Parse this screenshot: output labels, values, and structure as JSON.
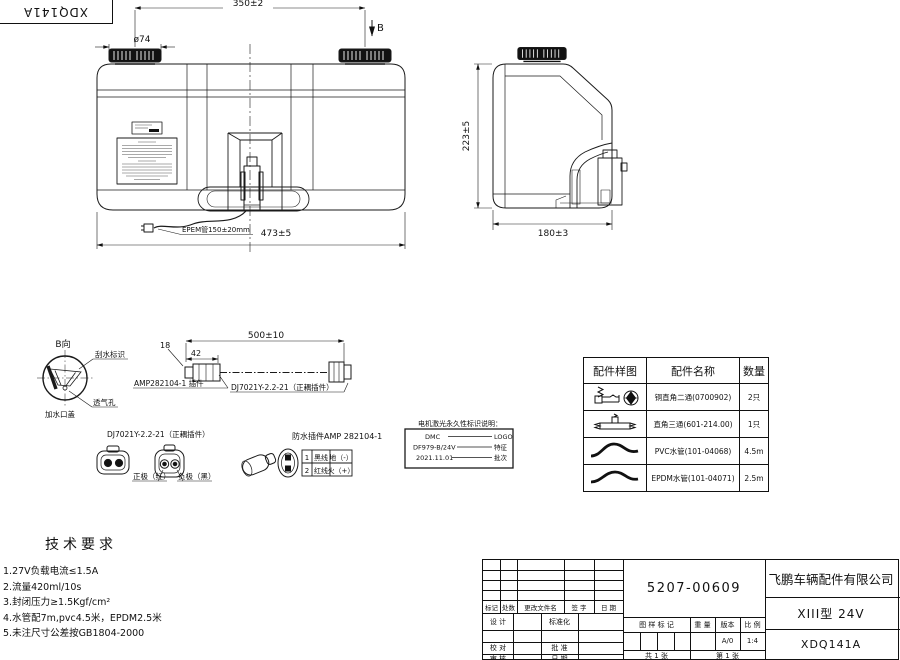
{
  "corner_stamp": {
    "text": "XDQ141A"
  },
  "front_view": {
    "dim_cap_spacing": "350±2",
    "dim_cap_diameter": "ø74",
    "section_marker": "B",
    "hose_label": "EPEM管150±20mm",
    "dim_overall_width": "473±5"
  },
  "side_view": {
    "dim_height": "223±5",
    "dim_depth": "180±3"
  },
  "view_b": {
    "title": "B向",
    "wiper_mark_label": "刮水标识",
    "vent_hole_label": "透气孔",
    "filler_cap_label": "加水口盖"
  },
  "cable_assembly": {
    "dim_connector": "18",
    "dim_lead": "42",
    "dim_length": "500±10",
    "left_connector_label": "AMP282104-1 插件",
    "right_connector_label": "DJ7021Y-2.2-21（正耦插件）"
  },
  "plug_detail": {
    "title": "DJ7021Y-2.2-21（正耦插件）",
    "positive_label": "正极（红）",
    "negative_label": "负极（黑）"
  },
  "waterproof_plug": {
    "title": "防水插件AMP 282104-1",
    "pin_rows": [
      {
        "pin": "1",
        "wire": "黑线",
        "role": "地（-）"
      },
      {
        "pin": "2",
        "wire": "红线",
        "role": "火（+）"
      }
    ]
  },
  "laser_marking": {
    "title": "电机激光永久性标识说明：",
    "rows": [
      {
        "value": "DMC",
        "label": "LOGO"
      },
      {
        "value": "DF979-B/24V",
        "label": "特征"
      },
      {
        "value": "2021.11.01",
        "label": "批次"
      }
    ]
  },
  "parts_table": {
    "headers": {
      "sample": "配件样图",
      "name": "配件名称",
      "qty": "数量"
    },
    "rows": [
      {
        "icon": "elbow-fitting",
        "name": "铜直角二通(0700902)",
        "qty": "2只"
      },
      {
        "icon": "tee-fitting",
        "name": "直角三通(601-214.00)",
        "qty": "1只"
      },
      {
        "icon": "pvc-hose",
        "name": "PVC水管(101-04068)",
        "qty": "4.5m"
      },
      {
        "icon": "epdm-hose",
        "name": "EPDM水管(101-04071)",
        "qty": "2.5m"
      }
    ]
  },
  "tech_requirements": {
    "title": "技术要求",
    "items": [
      "1.27V负载电流≤1.5A",
      "2.流量420ml/10s",
      "3.封闭压力≥1.5Kgf/cm²",
      "4.水管配7m,pvc4.5米，EPDM2.5米",
      "5.未注尺寸公差按GB1804-2000"
    ]
  },
  "title_block": {
    "part_number": "5207-00609",
    "company": "飞鹏车辆配件有限公司",
    "model": "XIII型 24V",
    "drawing_number": "XDQ141A",
    "revision_labels": {
      "mark": "标记",
      "count": "处数",
      "file": "更改文件名",
      "sign": "签 字",
      "date": "日 期"
    },
    "role_labels": {
      "design": "设 计",
      "standardize": "标准化",
      "check": "校 对",
      "approve": "批 准",
      "review": "审 核",
      "date": "日 期"
    },
    "stamp_label": "图 样 标 记",
    "weight_label": "重 量",
    "version_label": "版本",
    "scale_label": "比 例",
    "version": "A/0",
    "scale": "1:4",
    "sheet_total": "共 1 张",
    "sheet_no": "第 1 张"
  }
}
